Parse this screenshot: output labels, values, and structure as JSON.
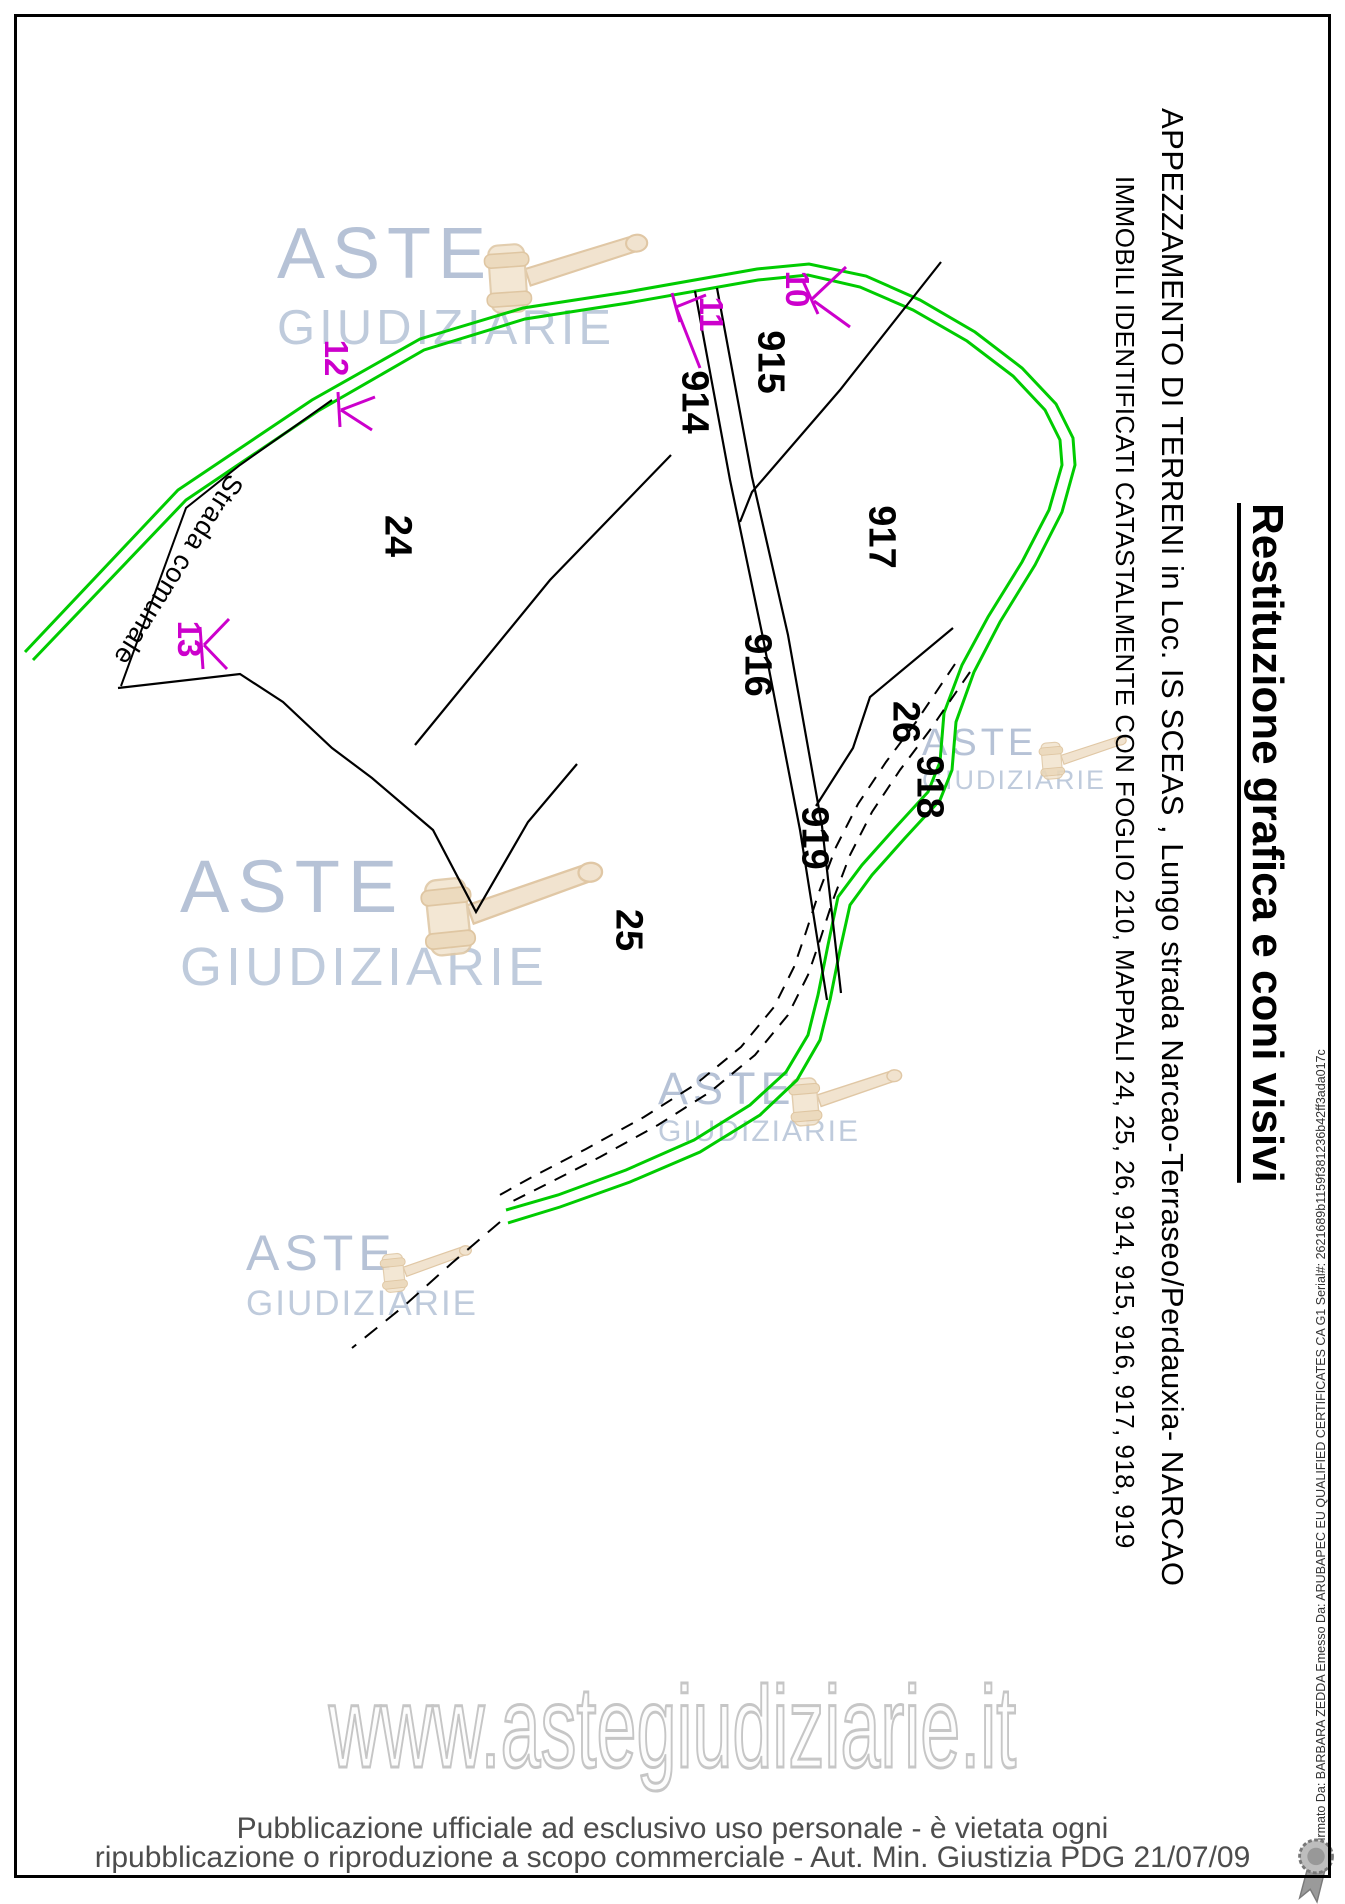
{
  "document": {
    "title_vertical": "Restituzione grafica e coni visivi",
    "caption_line1": "APPEZZAMENTO DI TERRENI in Loc. IS SCEAS ,  Lungo strada Narcao-Terraseo/Perdauxia- NARCAO",
    "caption_line2": "IMMOBILI IDENTIFICATI CATASTALMENTE CON FOGLIO 210, MAPPALI 24, 25, 26, 914, 915, 916, 917, 918, 919",
    "signature_margin": "Firmato Da: BARBARA ZEDDA Emesso Da: ARUBAPEC EU QUALIFIED CERTIFICATES CA G1 Serial#: 2621689b1159f381236b42ff3ada017c",
    "footer": {
      "watermark_url": "www.astegiudiziarie.it",
      "line1": "Pubblicazione ufficiale ad esclusivo uso personale - è vietata ogni",
      "line2": "ripubblicazione o riproduzione a scopo commerciale - Aut. Min. Giustizia PDG 21/07/09"
    }
  },
  "watermark": {
    "word1": "ASTE",
    "word2": "GIUDIZIARIE"
  },
  "map": {
    "road_label": "Strada comunale",
    "parcels": [
      {
        "id": "24",
        "label": "24"
      },
      {
        "id": "25",
        "label": "25"
      },
      {
        "id": "26",
        "label": "26"
      },
      {
        "id": "914",
        "label": "914"
      },
      {
        "id": "915",
        "label": "915"
      },
      {
        "id": "916",
        "label": "916"
      },
      {
        "id": "917",
        "label": "917"
      },
      {
        "id": "918",
        "label": "918"
      },
      {
        "id": "919",
        "label": "919"
      }
    ],
    "cones": [
      {
        "id": "10",
        "label": "10"
      },
      {
        "id": "11",
        "label": "11"
      },
      {
        "id": "12",
        "label": "12"
      },
      {
        "id": "13",
        "label": "13"
      }
    ],
    "colors": {
      "road_green": "#00cc00",
      "cone_magenta": "#cc00cc",
      "boundary_black": "#000000",
      "watermark_blue": "#a4b4cc"
    }
  }
}
